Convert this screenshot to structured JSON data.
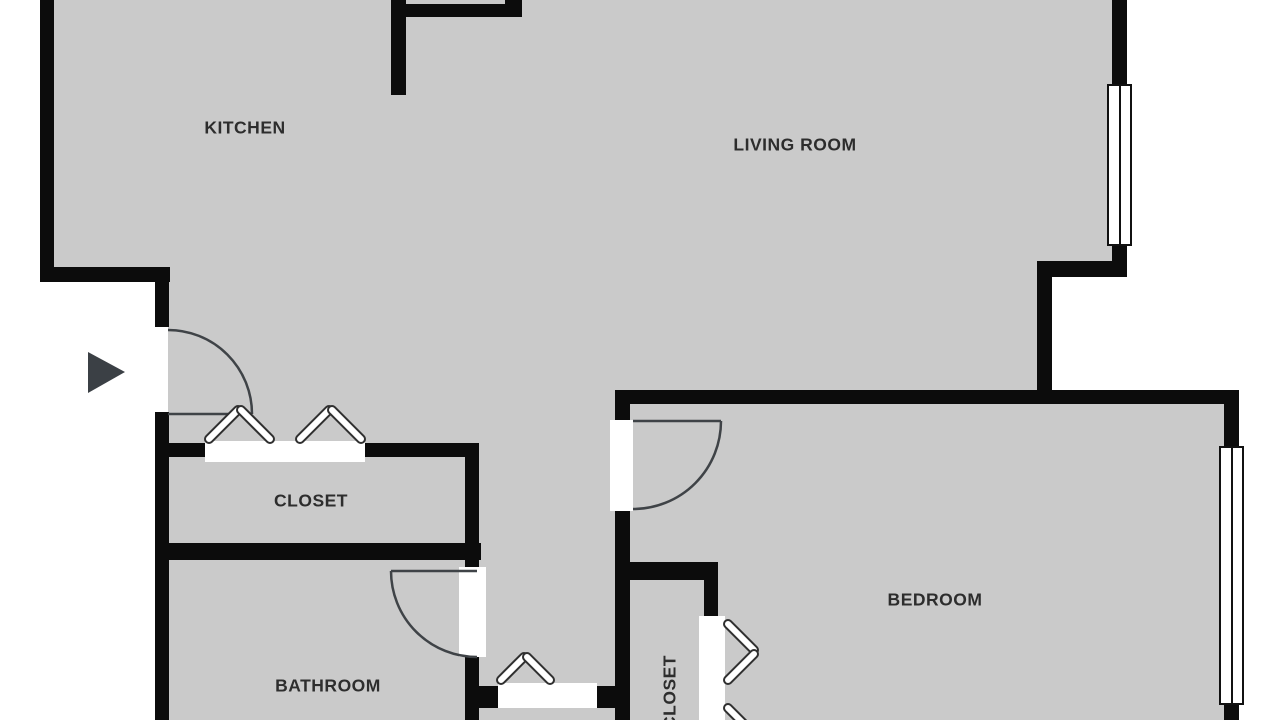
{
  "plan": {
    "type": "apartment-floor-plan",
    "rooms": [
      {
        "id": "kitchen",
        "label": "KITCHEN"
      },
      {
        "id": "living-room",
        "label": "LIVING ROOM"
      },
      {
        "id": "closet",
        "label": "CLOSET"
      },
      {
        "id": "bathroom",
        "label": "BATHROOM"
      },
      {
        "id": "bedroom",
        "label": "BEDROOM"
      },
      {
        "id": "bedroom-closet",
        "label": "CLOSET",
        "orientation": "vertical"
      }
    ],
    "symbols": {
      "entry_arrow": "right-pointing-triangle",
      "window_count": 2,
      "swing_door_count": 3,
      "bifold_door_pair_count": 5
    },
    "colors": {
      "background": "#ffffff",
      "floor": "#cacaca",
      "wall": "#0c0c0c",
      "label": "#2d2d2d",
      "door_line": "#3f4347",
      "entry_arrow": "#3b4045"
    }
  }
}
